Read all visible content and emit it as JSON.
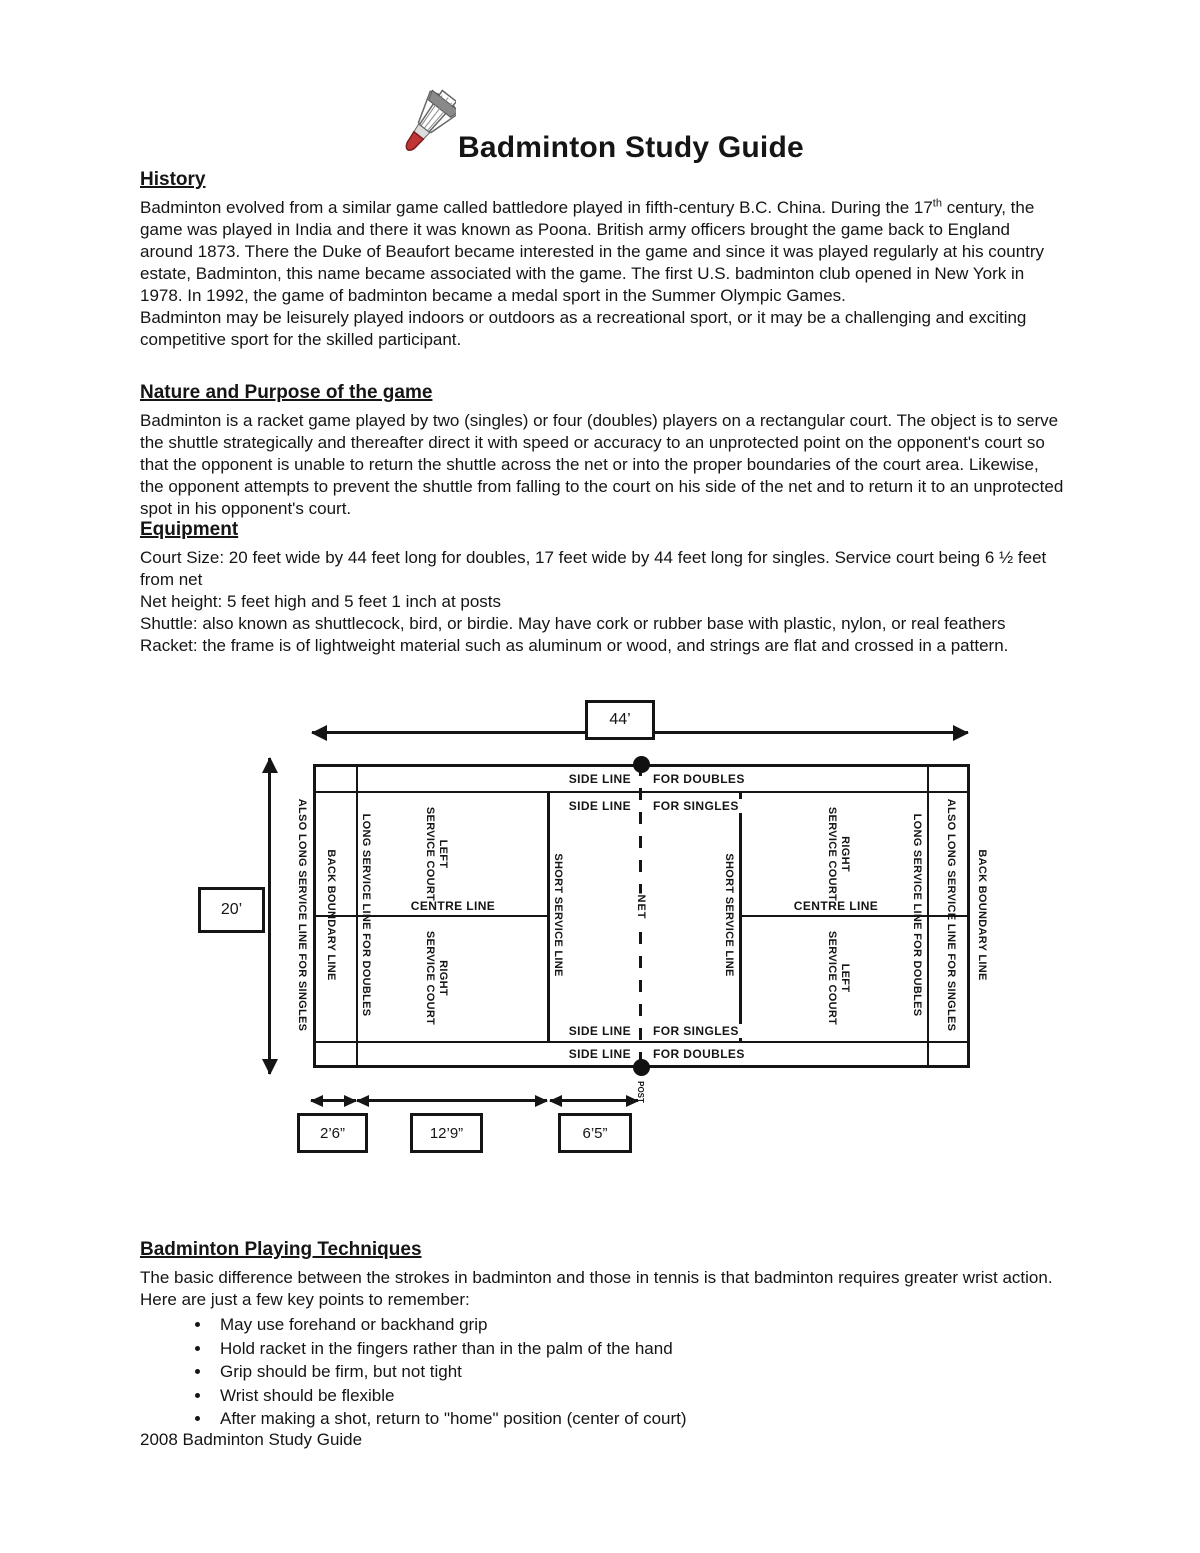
{
  "page": {
    "title": "Badminton Study Guide"
  },
  "sections": {
    "history": {
      "heading": "History",
      "p1_before": "Badminton evolved from a similar game called battledore played in fifth-century B.C. China. During the 17",
      "p1_sup": "th",
      "p1_after": " century, the game was played in India and there it was known as Poona. British army officers brought the game back to England around 1873. There the Duke of Beaufort became interested in the game and since it was played regularly at his country estate, Badminton, this name became associated with the game. The first U.S. badminton club opened in New York in 1978. In 1992, the game of badminton became a medal sport in the Summer Olympic Games.",
      "p2": "Badminton may be leisurely played indoors or outdoors as a recreational sport, or it may be a challenging and exciting competitive sport for the skilled participant."
    },
    "nature": {
      "heading": "Nature and Purpose of the game",
      "p1": "Badminton is a racket game played by two (singles) or four (doubles) players on a rectangular court. The object is to serve the shuttle strategically and thereafter direct it with speed or accuracy to an unprotected point on the opponent's court so that the opponent is unable to return the shuttle across the net or into the proper boundaries of the court area. Likewise, the opponent attempts to prevent the shuttle from falling to the court on his side of the net and to return it to an unprotected spot in his opponent's court."
    },
    "equipment": {
      "heading": "Equipment",
      "items": [
        "Court Size: 20 feet wide by 44 feet long for doubles, 17 feet wide by 44 feet long for singles. Service court being 6 ½ feet from net",
        "Net height: 5 feet high and 5 feet 1 inch at posts",
        "Shuttle: also known as shuttlecock, bird, or birdie. May have cork or rubber base with plastic, nylon, or real feathers",
        "Racket: the frame is of lightweight material such as aluminum or wood, and strings are flat and crossed in a pattern."
      ]
    },
    "techniques": {
      "heading": "Badminton Playing Techniques",
      "intro": "The basic difference between the strokes in badminton and those in tennis is that badminton requires greater wrist action. Here are just a few key points to remember:",
      "bullets": [
        "May use forehand or backhand grip",
        "Hold racket in the fingers rather than in the palm of the hand",
        "Grip should be firm, but not tight",
        "Wrist should be flexible",
        "After making a shot, return to \"home\" position (center of court)"
      ]
    }
  },
  "footer": "2008 Badminton Study Guide",
  "diagram": {
    "dims": {
      "length": "44’",
      "width": "20’",
      "back_alley": "2’6”",
      "service_length": "12’9”",
      "front_service": "6’5”"
    },
    "labels": {
      "side_line": "SIDE LINE",
      "for_doubles": "FOR DOUBLES",
      "for_singles": "FOR SINGLES",
      "centre_line": "CENTRE LINE",
      "net": "NET",
      "post": "POST",
      "also_long_service": "ALSO LONG SERVICE LINE FOR SINGLES",
      "back_boundary": "BACK BOUNDARY LINE",
      "long_service": "LONG SERVICE LINE FOR DOUBLES",
      "short_service": "SHORT SERVICE LINE",
      "left": "LEFT",
      "right": "RIGHT",
      "service_court": "SERVICE COURT"
    },
    "colors": {
      "ink": "#151515",
      "cork_red": "#c03434"
    }
  }
}
